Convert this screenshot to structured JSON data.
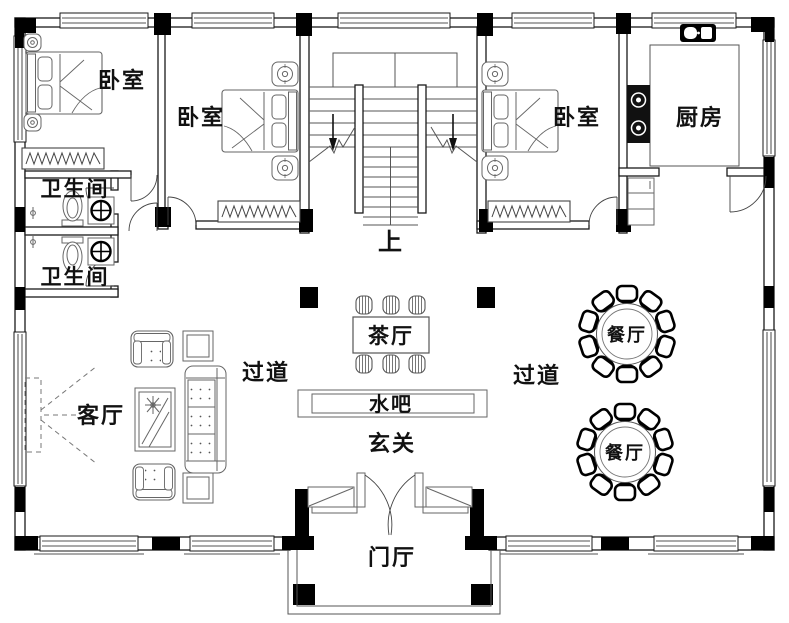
{
  "floor_plan": {
    "background": "#ffffff",
    "wall_color": "#000000",
    "line_color": "#1a1a1a",
    "labels": {
      "bedroom_top_left": "卧室",
      "bedroom_mid_left": "卧室",
      "bedroom_mid_right": "卧室",
      "kitchen": "厨房",
      "bathroom_upper": "卫生间",
      "bathroom_lower": "卫生间",
      "stairs_up": "上",
      "tea_hall": "茶厅",
      "corridor_left": "过道",
      "corridor_right": "过道",
      "water_bar": "水吧",
      "entry": "玄关",
      "living_room": "客厅",
      "dining_top": "餐厅",
      "dining_bottom": "餐厅",
      "foyer": "门厅"
    }
  }
}
